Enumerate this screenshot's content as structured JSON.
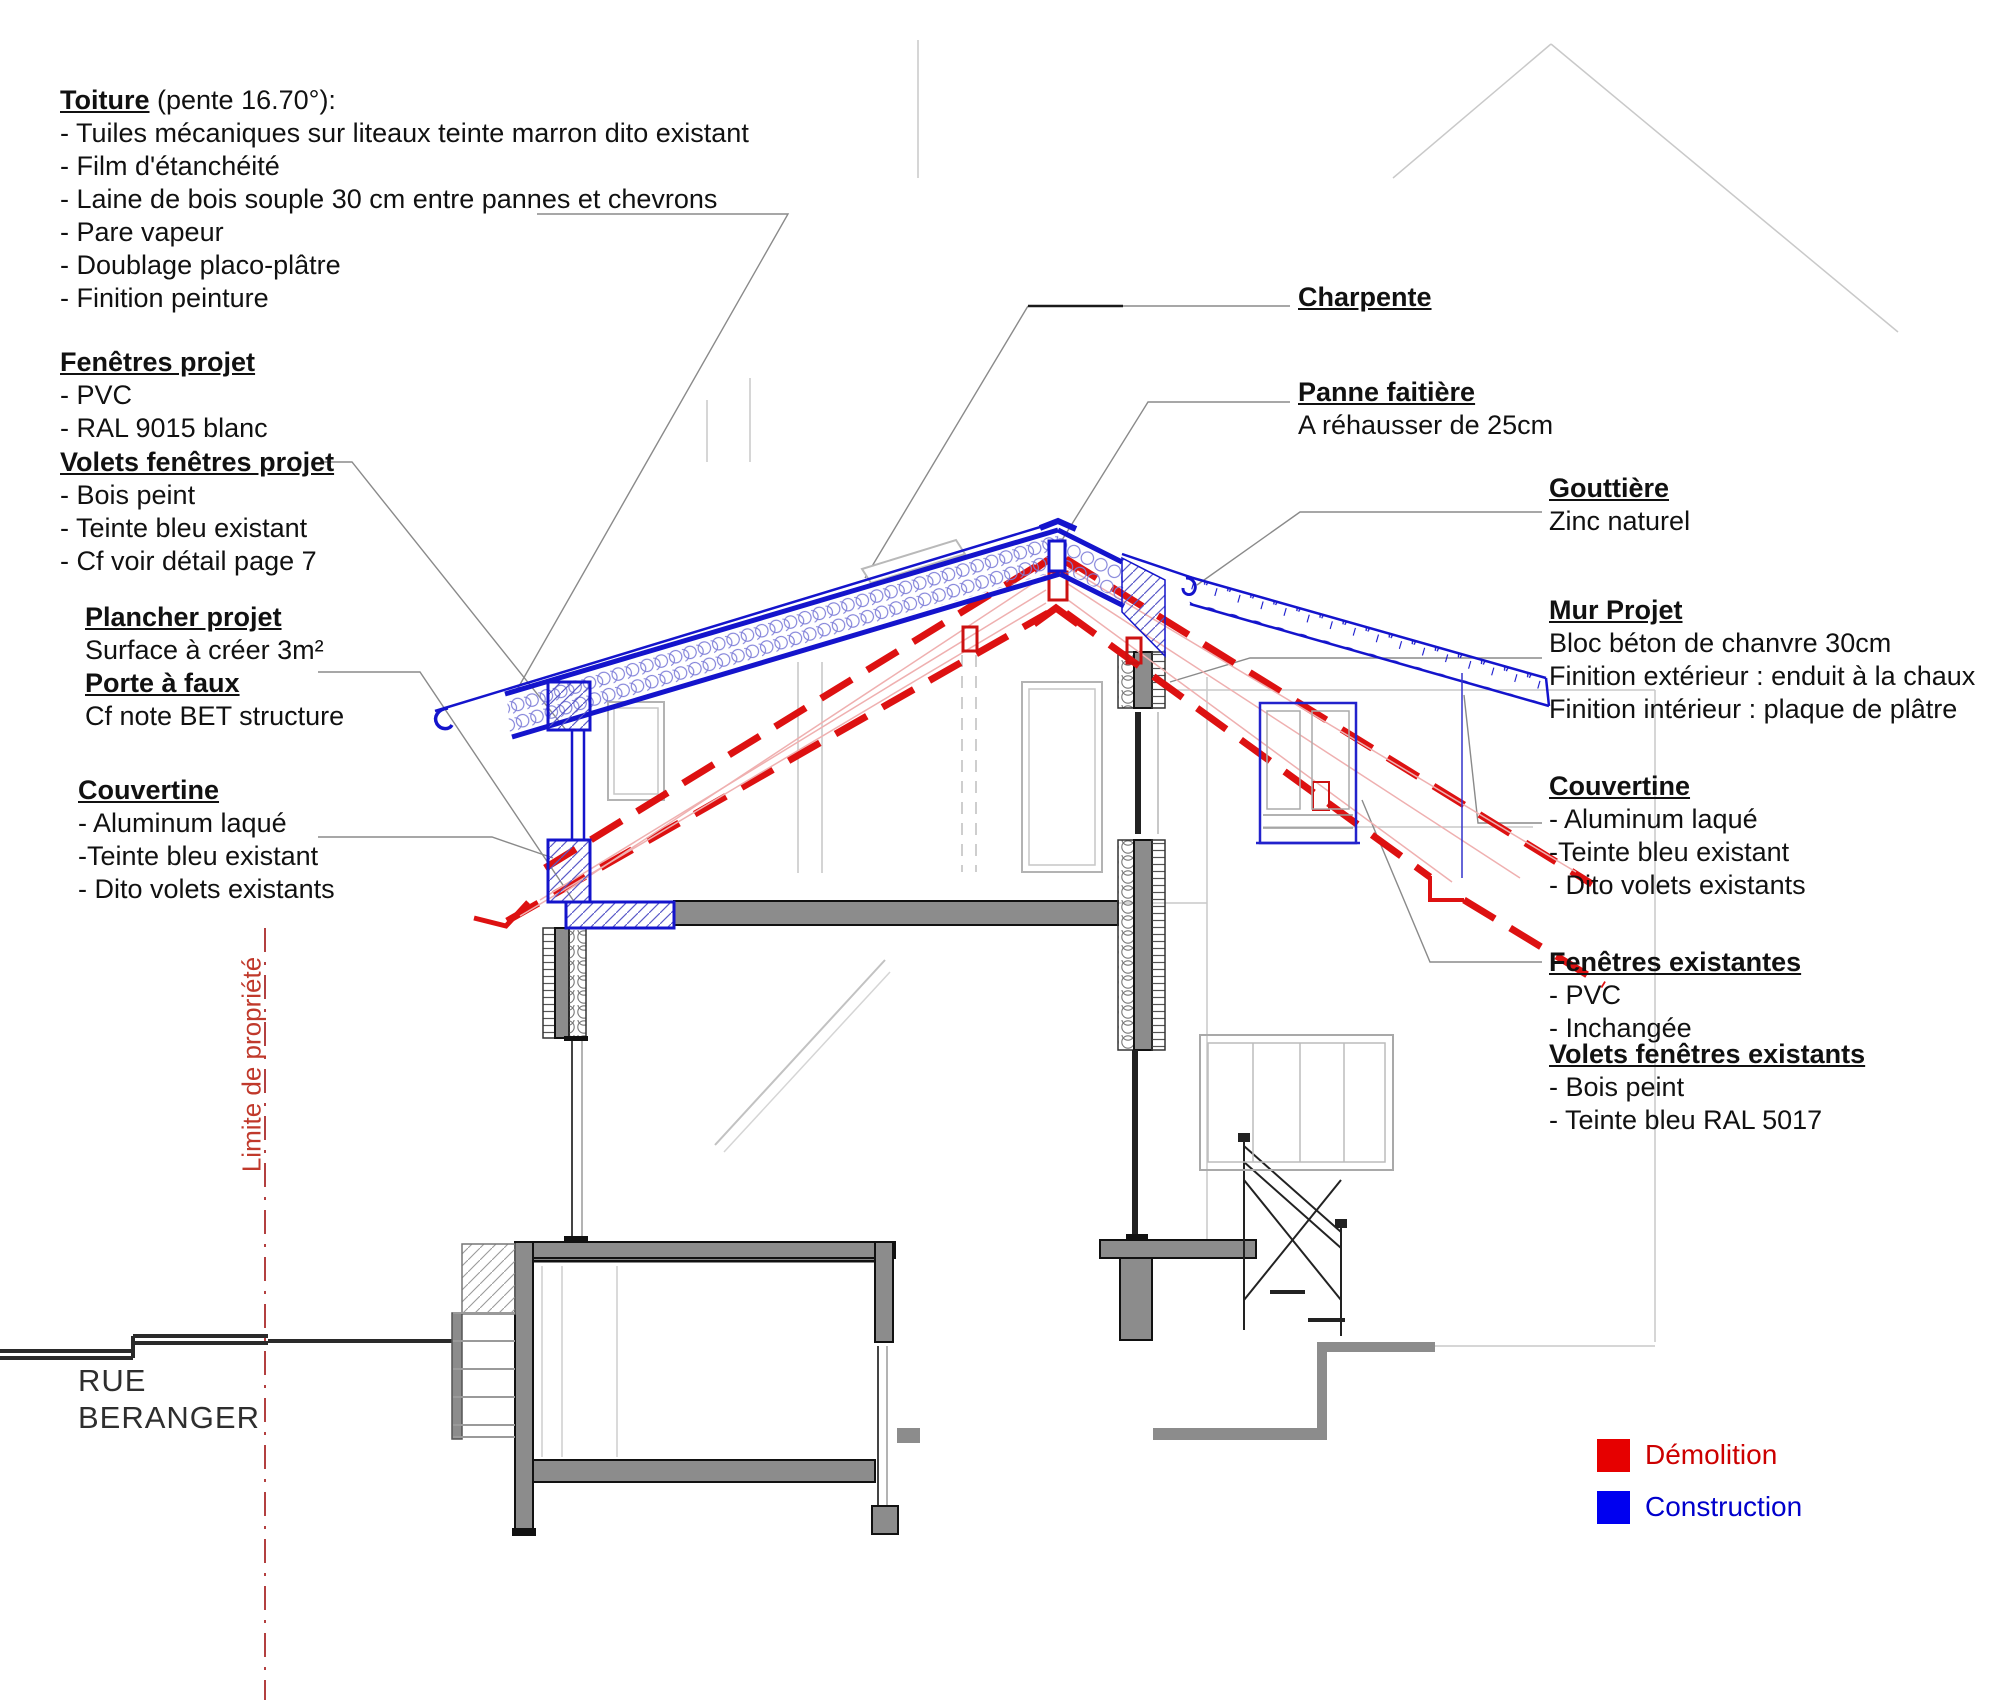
{
  "annotations": {
    "blocks": [
      {
        "id": "toiture",
        "title": "Toiture",
        "suffix": "(pente 16.70°):",
        "lines": [
          "- Tuiles mécaniques sur liteaux teinte marron dito existant",
          "- Film d'étanchéité",
          "- Laine de bois souple 30 cm entre pannes et chevrons",
          "- Pare vapeur",
          "- Doublage placo-plâtre",
          "- Finition peinture"
        ]
      },
      {
        "id": "fenetres-projet",
        "title": "Fenêtres projet",
        "lines": [
          "- PVC",
          "- RAL 9015 blanc"
        ]
      },
      {
        "id": "volets-fenetres-projet",
        "title": "Volets fenêtres projet",
        "lines": [
          "- Bois peint",
          "- Teinte bleu existant",
          "- Cf voir détail page 7"
        ]
      },
      {
        "id": "plancher-projet",
        "title": "Plancher projet",
        "lines": [
          "Surface à créer 3m²"
        ]
      },
      {
        "id": "porte-a-faux",
        "title": "Porte à faux",
        "lines": [
          "Cf note BET structure"
        ]
      },
      {
        "id": "couvertine-gauche",
        "title": "Couvertine",
        "lines": [
          "- Aluminum laqué",
          "-Teinte bleu existant",
          "- Dito volets existants"
        ]
      },
      {
        "id": "charpente",
        "title": "Charpente",
        "lines": []
      },
      {
        "id": "panne-faitiere",
        "title": "Panne faitière",
        "lines": [
          "A réhausser de 25cm"
        ]
      },
      {
        "id": "gouttiere",
        "title": "Gouttière",
        "lines": [
          "Zinc naturel"
        ]
      },
      {
        "id": "mur-projet",
        "title": "Mur Projet",
        "lines": [
          "Bloc béton de chanvre 30cm",
          "Finition extérieur : enduit à la chaux",
          "Finition intérieur : plaque de plâtre"
        ]
      },
      {
        "id": "couvertine-droite",
        "title": "Couvertine",
        "lines": [
          "- Aluminum laqué",
          "-Teinte bleu existant",
          "- Dito volets existants"
        ]
      },
      {
        "id": "fenetres-existantes",
        "title": "Fenêtres existantes",
        "lines": [
          "- PVC",
          "- Inchangée"
        ]
      },
      {
        "id": "volets-fenetres-existants",
        "title": "Volets fenêtres existants",
        "lines": [
          "- Bois peint",
          "- Teinte bleu RAL 5017"
        ]
      }
    ]
  },
  "street": {
    "line1": "RUE",
    "line2": "BERANGER"
  },
  "property_line": {
    "label": "Limite de propriété",
    "color": "#c0392b"
  },
  "legend": {
    "demolition_label": "Démolition",
    "construction_label": "Construction",
    "demolition_color": "#e60000",
    "construction_color": "#0000f0"
  },
  "drawing_colors": {
    "construction_blue": "#1414cc",
    "demolition_red": "#dd1111",
    "wall_gray": "#8c8c8c",
    "faint_gray": "#c9c9c9"
  }
}
